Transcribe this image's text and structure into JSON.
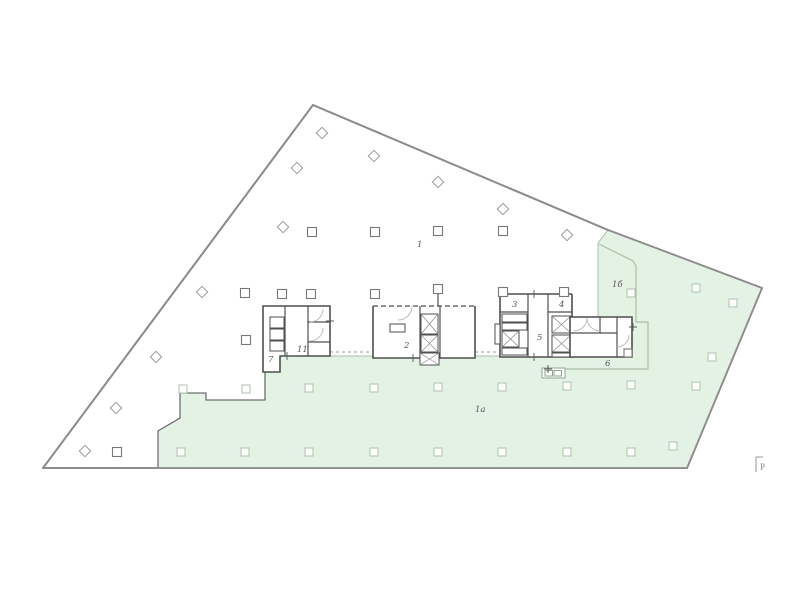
{
  "plan": {
    "type": "architectural-floor-plan",
    "room_labels": [
      {
        "text": "1",
        "x": 417,
        "y": 247
      },
      {
        "text": "2",
        "x": 404,
        "y": 348
      },
      {
        "text": "3",
        "x": 512,
        "y": 307
      },
      {
        "text": "4",
        "x": 559,
        "y": 307
      },
      {
        "text": "5",
        "x": 537,
        "y": 340
      },
      {
        "text": "6",
        "x": 605,
        "y": 366
      },
      {
        "text": "7",
        "x": 268,
        "y": 362
      },
      {
        "text": "11",
        "x": 297,
        "y": 352
      },
      {
        "text": "1а",
        "x": 475,
        "y": 412
      },
      {
        "text": "1б",
        "x": 612,
        "y": 287
      }
    ],
    "corner_marker": {
      "text": "P"
    },
    "colors": {
      "terrace_fill": "#e4f2e4",
      "building_outline": "#8d8d8d",
      "wall": "#4f4f4f",
      "walkway_line": "#a8c0a8",
      "terrace_edge_dark": "#6e6e6e"
    },
    "columns": {
      "dark_squares": [
        [
          312,
          232
        ],
        [
          375,
          232
        ],
        [
          438,
          231
        ],
        [
          503,
          231
        ],
        [
          245,
          293
        ],
        [
          282,
          294
        ],
        [
          311,
          294
        ],
        [
          375,
          294
        ],
        [
          438,
          289
        ],
        [
          503,
          292
        ],
        [
          564,
          292
        ],
        [
          246,
          340
        ],
        [
          117,
          452
        ]
      ],
      "light_squares": [
        [
          183,
          389
        ],
        [
          246,
          389
        ],
        [
          309,
          388
        ],
        [
          374,
          388
        ],
        [
          438,
          387
        ],
        [
          502,
          387
        ],
        [
          567,
          386
        ],
        [
          631,
          385
        ],
        [
          696,
          386
        ],
        [
          181,
          452
        ],
        [
          245,
          452
        ],
        [
          309,
          452
        ],
        [
          374,
          452
        ],
        [
          438,
          452
        ],
        [
          502,
          452
        ],
        [
          567,
          452
        ],
        [
          631,
          452
        ],
        [
          696,
          288
        ],
        [
          733,
          303
        ],
        [
          712,
          357
        ],
        [
          673,
          446
        ],
        [
          631,
          293
        ]
      ],
      "diamonds": [
        [
          322,
          133
        ],
        [
          374,
          156
        ],
        [
          438,
          182
        ],
        [
          503,
          209
        ],
        [
          567,
          235
        ],
        [
          297,
          168
        ],
        [
          283,
          227
        ],
        [
          202,
          292
        ],
        [
          156,
          357
        ],
        [
          116,
          408
        ],
        [
          85,
          451
        ]
      ]
    }
  }
}
